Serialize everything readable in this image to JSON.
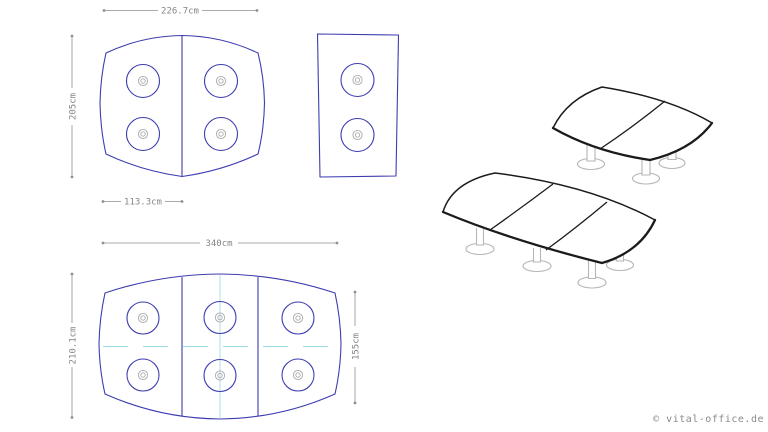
{
  "colors": {
    "background": "#ffffff",
    "outline_blue": "#3d3db0",
    "dimension_gray": "#8f8f8f",
    "centerline_cyan": "#9fdee8",
    "render_outline": "#1b1b1b",
    "leg_gray": "#b5b5b5"
  },
  "plans": {
    "two_segment": {
      "width_label": "226.7cm",
      "height_label": "205cm",
      "segment_width_label": "113.3cm"
    },
    "three_segment": {
      "width_label": "340cm",
      "height_label": "210.1cm",
      "side_height_label": "155cm"
    }
  },
  "watermark": {
    "text": "© vital-office.de"
  }
}
